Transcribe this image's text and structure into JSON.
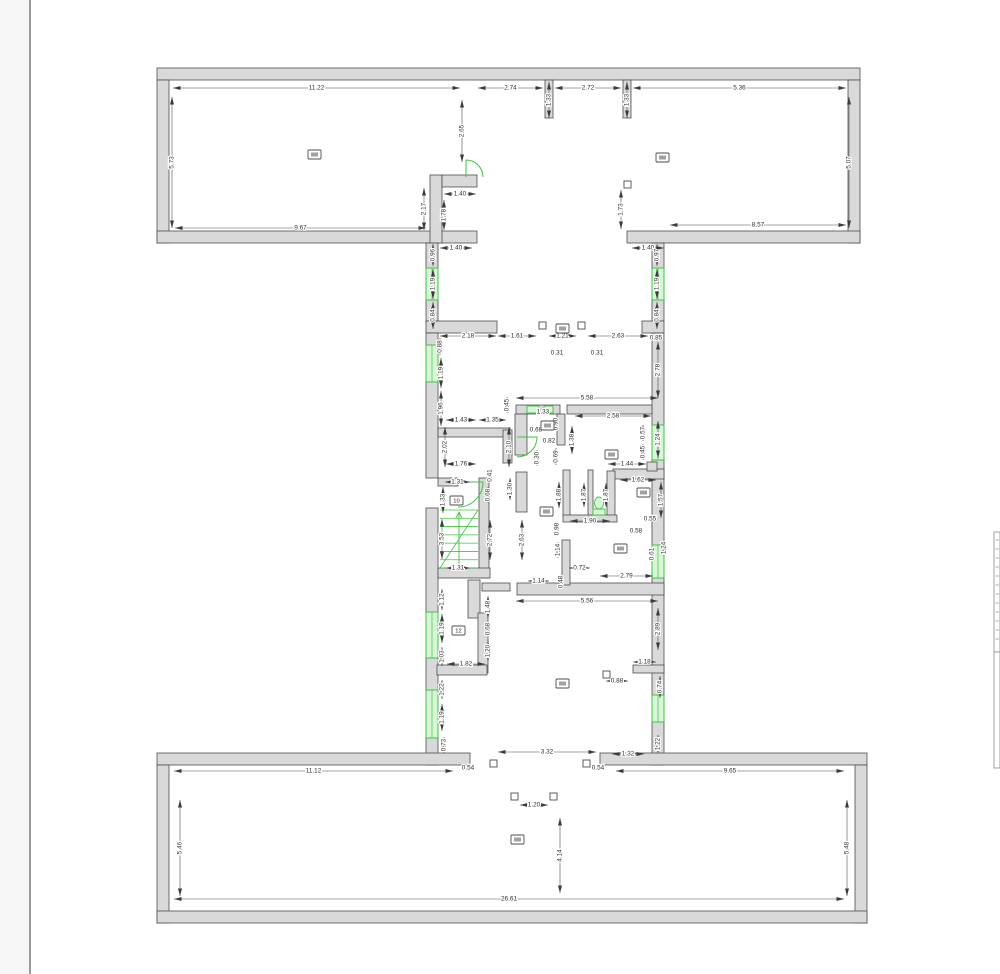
{
  "document": {
    "type": "floor-plan-drawing",
    "units": "m"
  },
  "colors": {
    "wall_fill": "#d9d9d9",
    "wall_stroke": "#4d4d4d",
    "dim_line": "#4d4d4d",
    "green": "#3fc43f",
    "green_fill": "#d9f5d9",
    "page_margin_fill": "#f7f7f7",
    "page_edge": "#9a9a9a",
    "strip_edge": "#8a8a8a"
  },
  "page": {
    "left_edge_x": 30,
    "width": 1000,
    "height": 974,
    "title_strip_boxes": [
      [
        994,
        532,
        6,
        120
      ],
      [
        994,
        652,
        6,
        116
      ]
    ],
    "title_strip_dash_count": 12
  },
  "drawing": {
    "walls": [
      [
        157,
        68,
        703,
        12
      ],
      [
        157,
        80,
        12,
        163
      ],
      [
        848,
        80,
        12,
        163
      ],
      [
        157,
        231,
        320,
        12
      ],
      [
        627,
        231,
        233,
        12
      ],
      [
        545,
        80,
        8,
        38
      ],
      [
        623,
        80,
        8,
        38
      ],
      [
        430,
        175,
        12,
        68
      ],
      [
        442,
        175,
        35,
        12
      ],
      [
        426,
        243,
        12,
        25
      ],
      [
        426,
        300,
        12,
        21
      ],
      [
        426,
        321,
        71,
        12
      ],
      [
        426,
        333,
        12,
        12
      ],
      [
        426,
        382,
        12,
        96
      ],
      [
        426,
        508,
        12,
        104
      ],
      [
        426,
        658,
        12,
        32
      ],
      [
        426,
        738,
        12,
        27
      ],
      [
        652,
        243,
        12,
        25
      ],
      [
        652,
        300,
        12,
        21
      ],
      [
        642,
        321,
        22,
        12
      ],
      [
        652,
        333,
        12,
        92
      ],
      [
        652,
        460,
        12,
        85
      ],
      [
        652,
        578,
        12,
        117
      ],
      [
        652,
        722,
        12,
        43
      ],
      [
        516,
        405,
        44,
        9
      ],
      [
        567,
        405,
        85,
        9
      ],
      [
        515,
        414,
        12,
        41
      ],
      [
        557,
        414,
        8,
        31
      ],
      [
        516,
        472,
        11,
        40
      ],
      [
        613,
        469,
        51,
        10
      ],
      [
        647,
        462,
        10,
        9
      ],
      [
        563,
        470,
        7,
        47
      ],
      [
        588,
        470,
        5,
        47
      ],
      [
        607,
        471,
        8,
        46
      ],
      [
        563,
        515,
        54,
        7
      ],
      [
        517,
        583,
        147,
        12
      ],
      [
        562,
        540,
        8,
        45
      ],
      [
        479,
        478,
        10,
        100
      ],
      [
        438,
        568,
        52,
        10
      ],
      [
        438,
        478,
        20,
        8
      ],
      [
        468,
        580,
        12,
        38
      ],
      [
        478,
        613,
        10,
        60
      ],
      [
        437,
        665,
        50,
        10
      ],
      [
        482,
        583,
        28,
        8
      ],
      [
        633,
        665,
        31,
        8
      ],
      [
        438,
        428,
        72,
        9
      ],
      [
        503,
        430,
        9,
        33
      ],
      [
        157,
        753,
        313,
        12
      ],
      [
        600,
        753,
        267,
        12
      ],
      [
        157,
        765,
        12,
        158
      ],
      [
        855,
        765,
        12,
        158
      ],
      [
        157,
        911,
        710,
        12
      ]
    ],
    "windows": [
      [
        426,
        268,
        12,
        32
      ],
      [
        426,
        345,
        12,
        37
      ],
      [
        426,
        612,
        12,
        46
      ],
      [
        426,
        690,
        12,
        48
      ],
      [
        652,
        268,
        12,
        32
      ],
      [
        652,
        425,
        12,
        35
      ],
      [
        652,
        545,
        12,
        33
      ],
      [
        652,
        695,
        12,
        27
      ]
    ],
    "doors": [
      "M466,177 L466,160 A17,17 0 0 1 483,177",
      "M458,482 L483,482 A25,25 0 0 1 458,507",
      "M517,437 L537,437 A20,20 0 0 1 517,457"
    ],
    "fixtures": [
      [
        527,
        406,
        12,
        7
      ],
      [
        544,
        406,
        9,
        7
      ]
    ],
    "wc": {
      "cx": 599,
      "cy": 503,
      "rx": 4.5,
      "ry": 6,
      "seat": [
        593,
        509,
        12,
        6
      ]
    },
    "stairs": {
      "x": 440,
      "y": 510,
      "w": 38,
      "h": 58,
      "n": 7
    },
    "columns": [
      [
        539,
        322
      ],
      [
        578,
        322
      ],
      [
        624,
        181
      ],
      [
        490,
        760
      ],
      [
        583,
        760
      ],
      [
        511,
        793
      ],
      [
        550,
        793
      ],
      [
        603,
        671
      ]
    ],
    "markers": [
      {
        "x": 308,
        "y": 150,
        "t": ""
      },
      {
        "x": 656,
        "y": 153,
        "t": ""
      },
      {
        "x": 556,
        "y": 324,
        "t": ""
      },
      {
        "x": 541,
        "y": 421,
        "t": ""
      },
      {
        "x": 605,
        "y": 450,
        "t": ""
      },
      {
        "x": 637,
        "y": 488,
        "t": ""
      },
      {
        "x": 614,
        "y": 544,
        "t": ""
      },
      {
        "x": 450,
        "y": 496,
        "t": "10"
      },
      {
        "x": 452,
        "y": 626,
        "t": "12"
      },
      {
        "x": 556,
        "y": 679,
        "t": ""
      },
      {
        "x": 511,
        "y": 835,
        "t": ""
      },
      {
        "x": 540,
        "y": 507,
        "t": ""
      }
    ],
    "dims": [
      [
        "11.22",
        173,
        88,
        460,
        88,
        "h"
      ],
      [
        "2.74",
        478,
        88,
        543,
        88,
        "h"
      ],
      [
        "1.33",
        549,
        82,
        549,
        118,
        "v"
      ],
      [
        "2.72",
        555,
        88,
        621,
        88,
        "h"
      ],
      [
        "1.33",
        627,
        82,
        627,
        118,
        "v"
      ],
      [
        "5.36",
        633,
        88,
        846,
        88,
        "h"
      ],
      [
        "5.73",
        172,
        97,
        172,
        228,
        "v"
      ],
      [
        "5.07",
        849,
        97,
        849,
        228,
        "v"
      ],
      [
        "2.65",
        462,
        100,
        462,
        162,
        "v"
      ],
      [
        "9.67",
        175,
        228,
        426,
        228,
        "h"
      ],
      [
        "8.57",
        670,
        225,
        846,
        225,
        "h"
      ],
      [
        "1.73",
        621,
        190,
        621,
        229,
        "v"
      ],
      [
        "1.40",
        444,
        194,
        476,
        194,
        "h"
      ],
      [
        "2.17",
        424,
        188,
        424,
        230,
        "v"
      ],
      [
        "1.78",
        444,
        200,
        444,
        230,
        "v"
      ],
      [
        "1.40",
        440,
        248,
        472,
        248,
        "h"
      ],
      [
        "0.96",
        433,
        244,
        433,
        266,
        "v"
      ],
      [
        "1.19",
        433,
        269,
        433,
        299,
        "v"
      ],
      [
        "0.84",
        433,
        302,
        433,
        329,
        "v"
      ],
      [
        "1.40",
        632,
        248,
        664,
        248,
        "h"
      ],
      [
        "0.97",
        657,
        244,
        657,
        266,
        "v"
      ],
      [
        "1.19",
        657,
        269,
        657,
        299,
        "v"
      ],
      [
        "0.84",
        657,
        302,
        657,
        329,
        "v"
      ],
      [
        "2.18",
        440,
        336,
        496,
        336,
        "h"
      ],
      [
        "1.61",
        498,
        336,
        536,
        336,
        "h"
      ],
      [
        "1.21",
        549,
        336,
        576,
        336,
        "h"
      ],
      [
        "2.63",
        588,
        336,
        648,
        336,
        "h"
      ],
      [
        "0.85",
        656,
        338,
        656,
        338,
        "t"
      ],
      [
        "0.31",
        557,
        353,
        557,
        353,
        "t"
      ],
      [
        "0.31",
        597,
        353,
        597,
        353,
        "t"
      ],
      [
        "0.88",
        440,
        338,
        440,
        355,
        "v"
      ],
      [
        "1.19",
        441,
        358,
        441,
        388,
        "v"
      ],
      [
        "1.96",
        441,
        391,
        441,
        426,
        "v"
      ],
      [
        "2.78",
        658,
        342,
        658,
        398,
        "v"
      ],
      [
        "5.58",
        516,
        398,
        658,
        398,
        "h"
      ],
      [
        "2.58",
        575,
        416,
        651,
        416,
        "h"
      ],
      [
        "1.33",
        543,
        412,
        543,
        412,
        "t"
      ],
      [
        "0.68",
        536,
        430,
        536,
        430,
        "t"
      ],
      [
        "0.90",
        556,
        424,
        556,
        424,
        "tv"
      ],
      [
        "1.38",
        572,
        426,
        572,
        454,
        "v"
      ],
      [
        "0.57",
        643,
        425,
        643,
        441,
        "v"
      ],
      [
        "0.45",
        643,
        444,
        643,
        460,
        "v"
      ],
      [
        "1.24",
        658,
        421,
        658,
        458,
        "v"
      ],
      [
        "1.44",
        608,
        464,
        646,
        464,
        "h"
      ],
      [
        "1.62",
        620,
        480,
        656,
        480,
        "h"
      ],
      [
        "1.57",
        661,
        482,
        661,
        518,
        "v"
      ],
      [
        "1.43",
        446,
        420,
        476,
        420,
        "h"
      ],
      [
        "1.35",
        479,
        420,
        506,
        420,
        "h"
      ],
      [
        "2.02",
        445,
        427,
        445,
        467,
        "v"
      ],
      [
        "2.10",
        509,
        427,
        509,
        467,
        "v"
      ],
      [
        "0.45",
        507,
        397,
        507,
        413,
        "v"
      ],
      [
        "1.76",
        446,
        464,
        476,
        464,
        "h"
      ],
      [
        "0.41",
        490,
        469,
        490,
        482,
        "v"
      ],
      [
        "0.68",
        488,
        487,
        488,
        503,
        "v"
      ],
      [
        "1.31",
        445,
        482,
        470,
        482,
        "h"
      ],
      [
        "1.33",
        443,
        487,
        443,
        513,
        "v"
      ],
      [
        "0.30",
        537,
        450,
        537,
        466,
        "v"
      ],
      [
        "0.69",
        556,
        448,
        556,
        465,
        "v"
      ],
      [
        "0.82",
        549,
        441,
        549,
        441,
        "t"
      ],
      [
        "1.30",
        510,
        478,
        510,
        500,
        "v"
      ],
      [
        "1.88",
        559,
        482,
        559,
        508,
        "v"
      ],
      [
        "1.87",
        584,
        483,
        584,
        507,
        "v"
      ],
      [
        "1.87",
        606,
        483,
        606,
        507,
        "v"
      ],
      [
        "1.90",
        570,
        521,
        610,
        521,
        "h"
      ],
      [
        "0.98",
        557,
        529,
        557,
        529,
        "tv"
      ],
      [
        "0.55",
        650,
        519,
        650,
        519,
        "t"
      ],
      [
        "0.58",
        636,
        531,
        636,
        531,
        "t"
      ],
      [
        "0.61",
        652,
        547,
        652,
        561,
        "v"
      ],
      [
        "1.24",
        664,
        540,
        664,
        556,
        "v"
      ],
      [
        "3.53",
        442,
        519,
        442,
        559,
        "v"
      ],
      [
        "1.31",
        446,
        568,
        470,
        568,
        "h"
      ],
      [
        "2.72",
        490,
        520,
        490,
        560,
        "v"
      ],
      [
        "2.63",
        522,
        520,
        522,
        560,
        "v"
      ],
      [
        "1.14",
        558,
        542,
        558,
        558,
        "v"
      ],
      [
        "0.48",
        561,
        575,
        561,
        589,
        "v"
      ],
      [
        "1.14",
        528,
        581,
        549,
        581,
        "h"
      ],
      [
        "0.72",
        569,
        568,
        590,
        568,
        "h"
      ],
      [
        "2.79",
        600,
        576,
        653,
        576,
        "h"
      ],
      [
        "5.56",
        516,
        601,
        658,
        601,
        "h"
      ],
      [
        "2.89",
        658,
        608,
        658,
        650,
        "v"
      ],
      [
        "1.18",
        633,
        662,
        656,
        662,
        "h"
      ],
      [
        "0.88",
        606,
        681,
        628,
        681,
        "h"
      ],
      [
        "0.74",
        660,
        676,
        660,
        698,
        "v"
      ],
      [
        "1.12",
        442,
        589,
        442,
        610,
        "v"
      ],
      [
        "1.19",
        442,
        614,
        442,
        643,
        "v"
      ],
      [
        "1.03",
        442,
        647,
        442,
        666,
        "v"
      ],
      [
        "1.82",
        447,
        664,
        485,
        664,
        "h"
      ],
      [
        "1.48",
        488,
        596,
        488,
        618,
        "v"
      ],
      [
        "0.68",
        488,
        622,
        488,
        636,
        "v"
      ],
      [
        "1.20",
        488,
        641,
        488,
        661,
        "v"
      ],
      [
        "1.22",
        442,
        680,
        442,
        699,
        "v"
      ],
      [
        "1.19",
        442,
        704,
        442,
        731,
        "v"
      ],
      [
        "0.73",
        444,
        737,
        444,
        753,
        "v"
      ],
      [
        "0.54",
        468,
        768,
        468,
        768,
        "t"
      ],
      [
        "3.32",
        498,
        752,
        596,
        752,
        "h"
      ],
      [
        "0.54",
        598,
        768,
        598,
        768,
        "t"
      ],
      [
        "1.32",
        612,
        754,
        644,
        754,
        "h"
      ],
      [
        "1.22",
        658,
        735,
        658,
        753,
        "v"
      ],
      [
        "11.12",
        174,
        771,
        453,
        771,
        "h"
      ],
      [
        "9.65",
        616,
        771,
        844,
        771,
        "h"
      ],
      [
        "5.46",
        180,
        800,
        180,
        896,
        "v"
      ],
      [
        "5.48",
        847,
        800,
        847,
        896,
        "v"
      ],
      [
        "4.14",
        560,
        818,
        560,
        893,
        "v"
      ],
      [
        "1.20",
        520,
        805,
        548,
        805,
        "h"
      ],
      [
        "26.61",
        174,
        899,
        844,
        899,
        "h"
      ]
    ]
  }
}
